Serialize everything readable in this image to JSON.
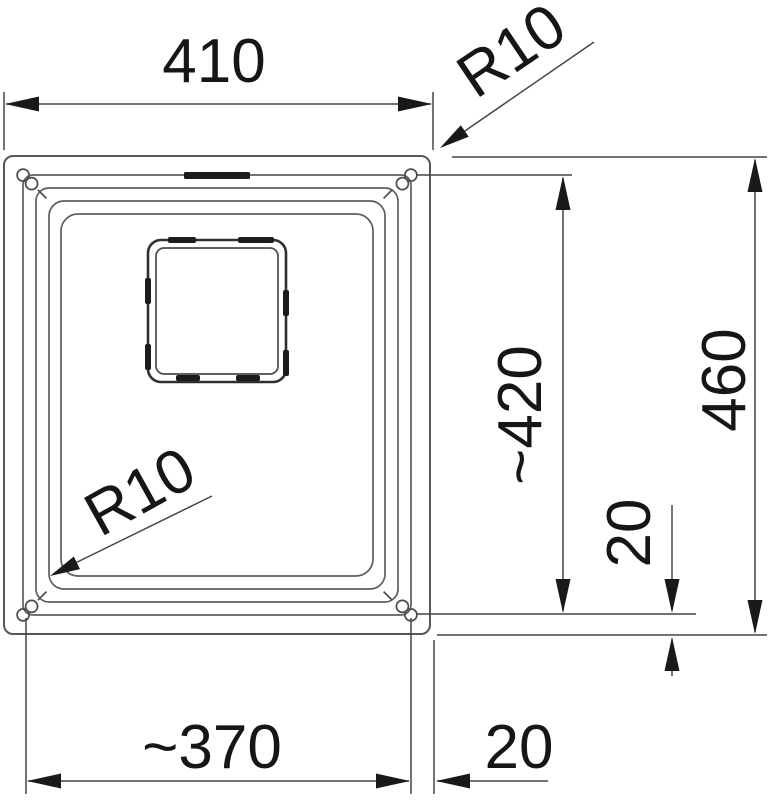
{
  "drawing": {
    "type": "sink plan view technical drawing",
    "colors": {
      "background": "#ffffff",
      "outline": "#575757",
      "dimension_lines": "#454545",
      "text": "#161616"
    },
    "dimensions": {
      "outer_width": "410",
      "outer_corner_radius": "R10",
      "inner_length": "~420",
      "outer_length": "460",
      "rim_offset_right": "20",
      "bowl_corner_radius": "R10",
      "inner_width": "~370",
      "rim_offset_bottom": "20"
    }
  }
}
